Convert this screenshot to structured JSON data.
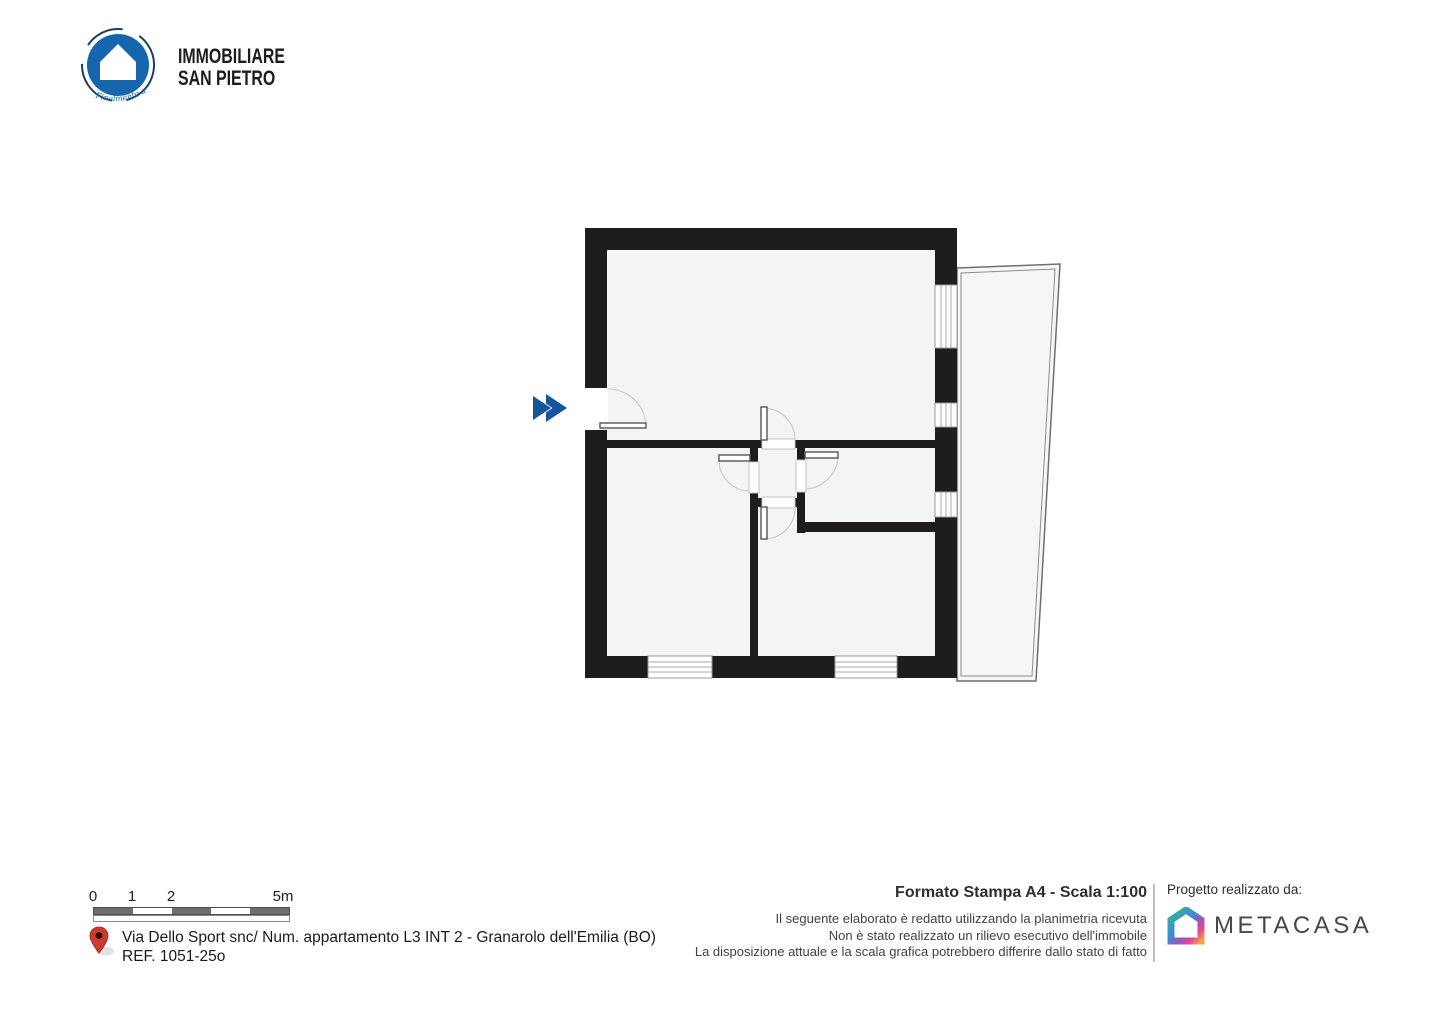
{
  "header": {
    "brand_line1": "IMMOBILIARE",
    "brand_line2": "SAN PIETRO",
    "tagline": "Finalmente a Casa"
  },
  "scale_bar": {
    "labels": [
      "0",
      "1",
      "2",
      "5m"
    ]
  },
  "address": {
    "line1": "Via Dello Sport snc/ Num. appartamento L3 INT 2 - Granarolo dell'Emilia (BO)",
    "line2": "REF. 1051-25o"
  },
  "print_info": {
    "title": "Formato Stampa A4 - Scala 1:100",
    "disclaimer_line1": "Il seguente elaborato è redatto utilizzando la planimetria ricevuta",
    "disclaimer_line2": "Non è stato realizzato un rilievo esecutivo dell'immobile",
    "disclaimer_line3": "La disposizione attuale e la scala grafica potrebbero differire dallo stato di fatto"
  },
  "credits": {
    "label": "Progetto realizzato da:",
    "brand": "METACASA"
  },
  "icons": {
    "brand_logo": "house-in-circle-icon",
    "entry_marker": "double-chevron-right-icon",
    "location": "map-pin-icon",
    "credits_logo": "gradient-house-icon"
  },
  "colors": {
    "wall": "#1d1d20",
    "floor": "#f3f4f6",
    "brand_blue": "#1566ac",
    "chevron_blue": "#16549e",
    "pin_red": "#cf3a30",
    "metacasa_gradient": [
      "#31b98f",
      "#3d8fd4",
      "#8a5bc6",
      "#e0488f",
      "#f2a04d"
    ]
  }
}
